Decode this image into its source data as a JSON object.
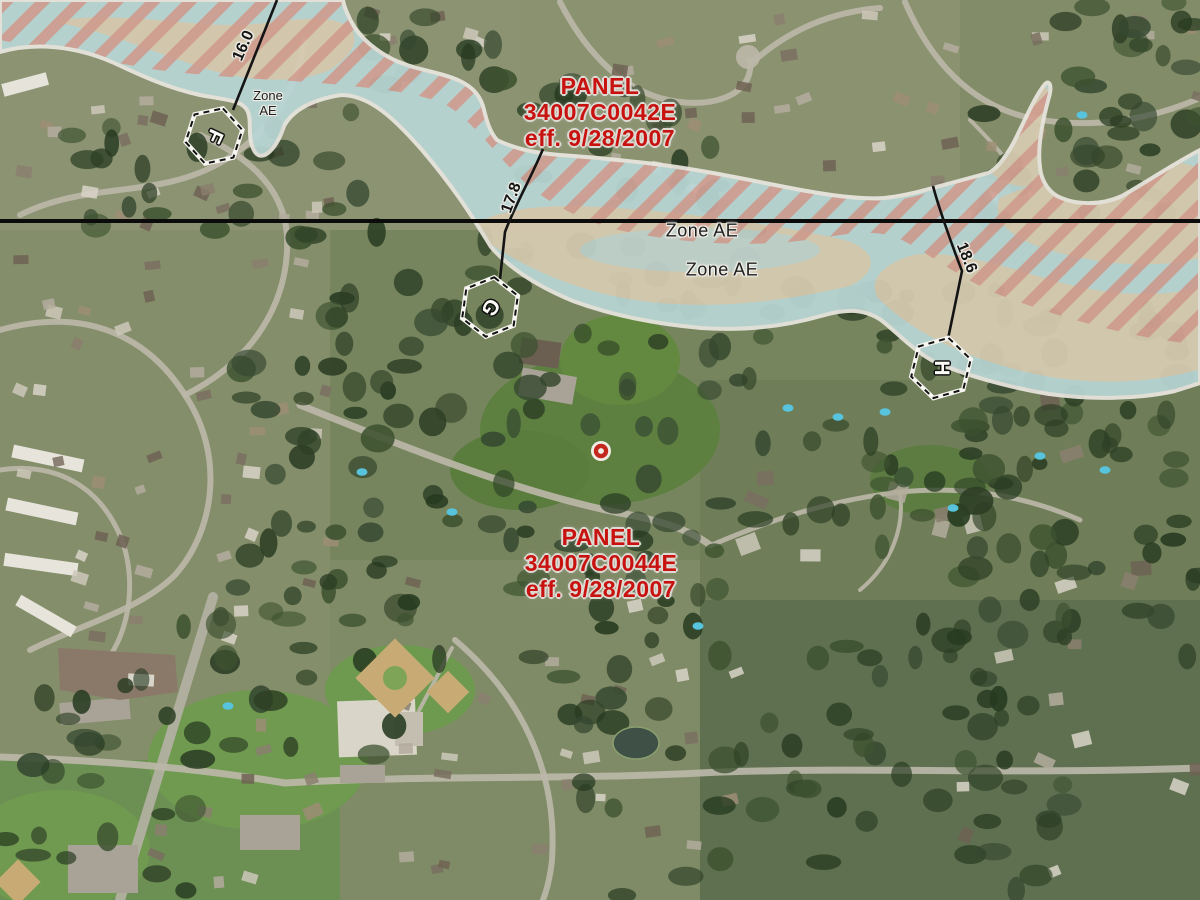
{
  "map": {
    "title": "FEMA flood hazard overlay on aerial imagery",
    "panels": [
      {
        "label": "PANEL",
        "number": "34007C0042E",
        "effective": "eff. 9/28/2007"
      },
      {
        "label": "PANEL",
        "number": "34007C0044E",
        "effective": "eff. 9/28/2007"
      }
    ],
    "flood_zone": {
      "small_label": {
        "line1": "Zone",
        "line2": "AE"
      },
      "labels": [
        "Zone AE",
        "Zone AE"
      ]
    },
    "cross_sections": [
      {
        "letter": "F",
        "elevation": "16.0"
      },
      {
        "letter": "G",
        "elevation": "17.8"
      },
      {
        "letter": "H",
        "elevation": "18.6"
      }
    ],
    "colors": {
      "panel_text": "#c8120f",
      "flood_fill": "#b9d6d5",
      "floodway_stripe": "#d49a8e",
      "flood_fringe_beige": "#d9cbb0",
      "zone_boundary": "#e9e6df",
      "section_line": "#141414",
      "panel_boundary_line": "#0b0b0b",
      "marker_red": "#c3281c"
    }
  }
}
